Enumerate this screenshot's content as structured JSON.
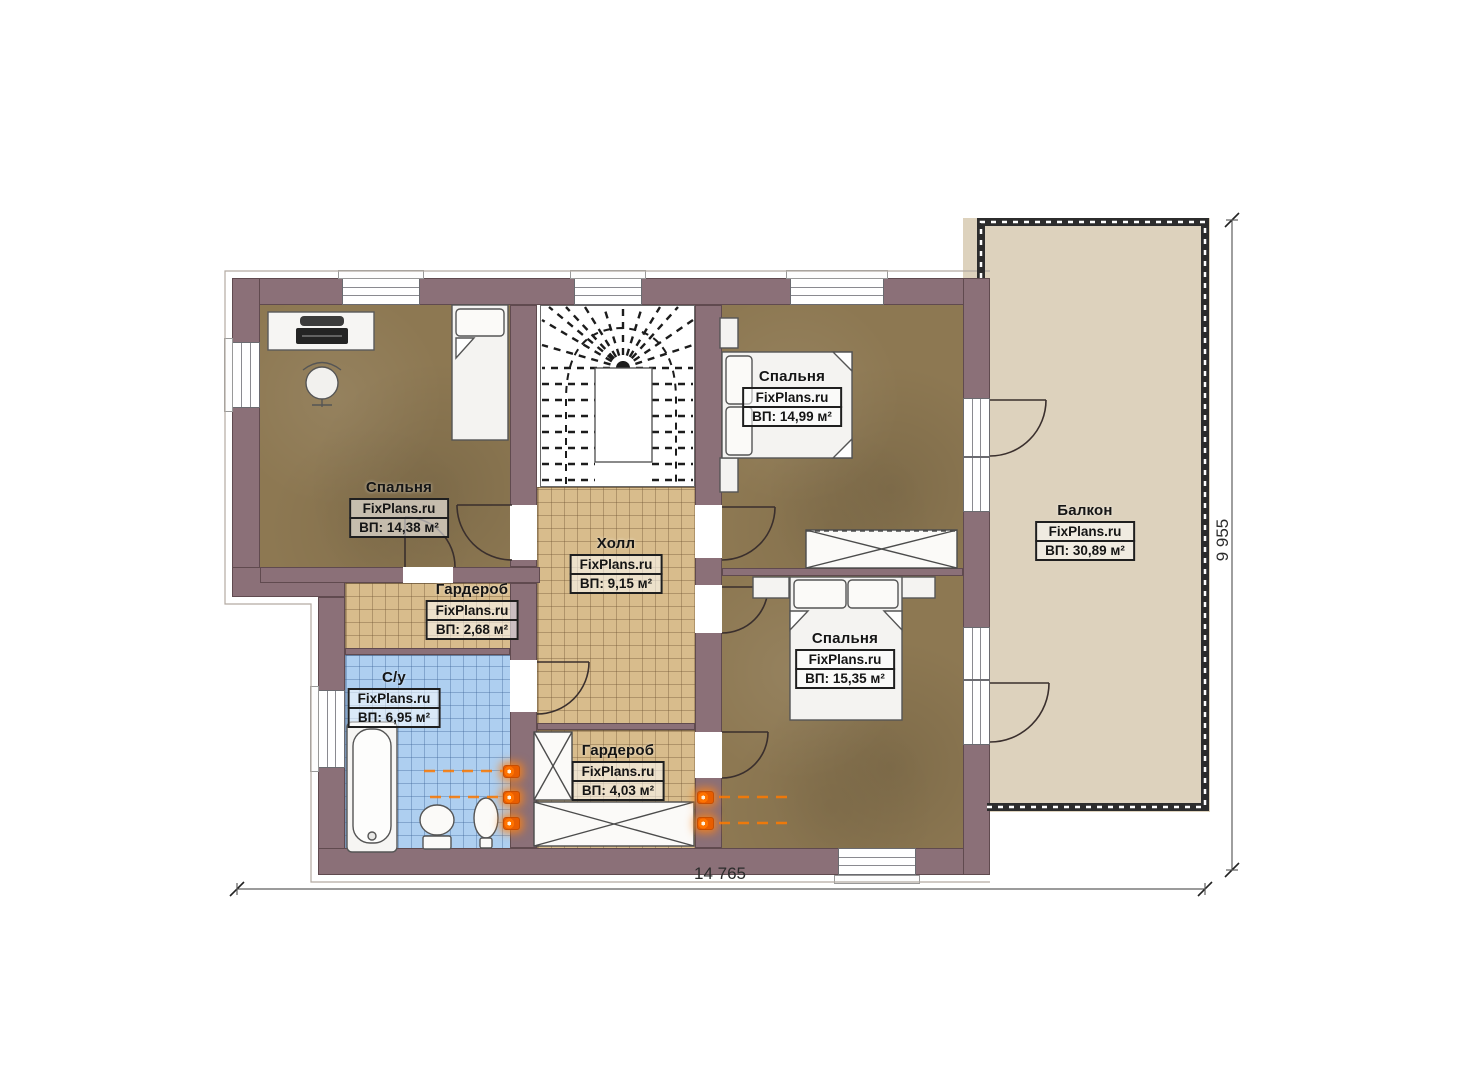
{
  "plan": {
    "brand": "FixPlans.ru",
    "rooms": [
      {
        "id": "bedroom-top-left",
        "name": "Спальня",
        "brand": "FixPlans.ru",
        "area": "ВП: 14,38 м²"
      },
      {
        "id": "bedroom-top-right",
        "name": "Спальня",
        "brand": "FixPlans.ru",
        "area": "ВП: 14,99 м²"
      },
      {
        "id": "bedroom-bottom-right",
        "name": "Спальня",
        "brand": "FixPlans.ru",
        "area": "ВП: 15,35 м²"
      },
      {
        "id": "hall",
        "name": "Холл",
        "brand": "FixPlans.ru",
        "area": "ВП: 9,15 м²"
      },
      {
        "id": "wardrobe-small",
        "name": "Гардероб",
        "brand": "FixPlans.ru",
        "area": "ВП: 2,68 м²"
      },
      {
        "id": "bathroom",
        "name": "С/у",
        "brand": "FixPlans.ru",
        "area": "ВП: 6,95 м²"
      },
      {
        "id": "wardrobe-large",
        "name": "Гардероб",
        "brand": "FixPlans.ru",
        "area": "ВП: 4,03 м²"
      },
      {
        "id": "balcony",
        "name": "Балкон",
        "brand": "FixPlans.ru",
        "area": "ВП: 30,89 м²"
      }
    ],
    "dimensions": {
      "width_label": "14 765",
      "height_label": "9 955"
    },
    "colors": {
      "wall": "#8b7078",
      "wood_floor": "#8d7852",
      "tile_tan": "#d8bc8c",
      "tile_blue": "#aecff0",
      "balcony_floor": "#ddd2bd",
      "heating_accent": "#ff7300",
      "label_border": "#1f1f1f"
    }
  }
}
